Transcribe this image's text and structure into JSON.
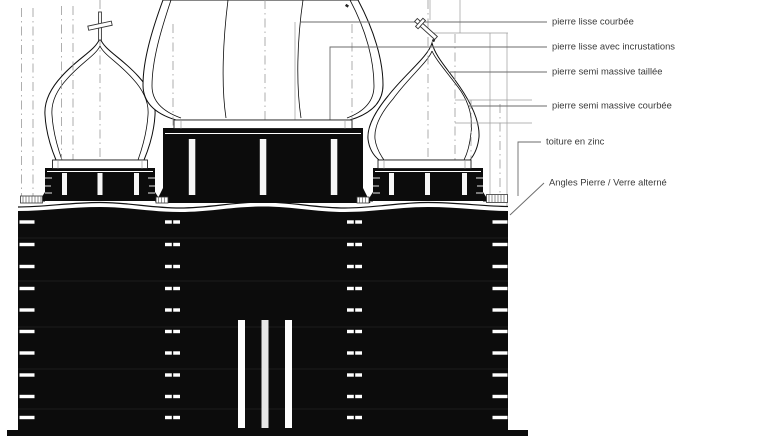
{
  "annotations": {
    "items": [
      {
        "label": "pierre lisse courbée"
      },
      {
        "label": "pierre lisse avec incrustations"
      },
      {
        "label": "pierre semi massive taillée"
      },
      {
        "label": "pierre semi massive courbée"
      },
      {
        "label": "toiture en zinc"
      },
      {
        "label": "Angles Pierre / Verre alterné"
      }
    ]
  },
  "colors": {
    "ink": "#0c0c0c",
    "construction_line": "#9a9a9a",
    "label_text": "#3a3a3a",
    "background": "#ffffff"
  }
}
